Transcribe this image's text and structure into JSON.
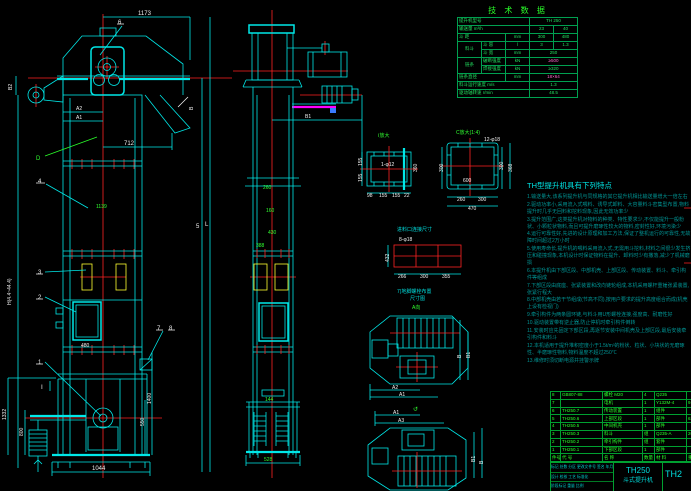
{
  "front_view": {
    "balloons": {
      "n1": "1",
      "n2": "2",
      "n3": "3",
      "n4": "4",
      "n5": "5",
      "n6": "6",
      "n7": "7",
      "n8": "8",
      "d": "D",
      "section": "Ⅰ"
    },
    "dims": {
      "overall_width": "1173",
      "chute": "712",
      "a1": "A1",
      "a2": "A2",
      "b2": "B2",
      "b": "B",
      "height": "H(4.4~44.4)",
      "length": "L",
      "pitch": "1139",
      "door": "480",
      "base": "1044",
      "boot_height": "1400",
      "boot_shaft": "550",
      "left_a": "1332",
      "left_b": "800"
    }
  },
  "side_view": {
    "dims": {
      "b1": "B1",
      "top": "260",
      "neck": "160",
      "mid": "430",
      "width": "388",
      "plate": "144",
      "base": "528"
    }
  },
  "details": {
    "detail_i": {
      "label": "Ⅰ放大",
      "hole": "1-φ12",
      "left_a": "155",
      "left_b": "155",
      "right": "360",
      "bot_a": "98",
      "bot_b": "155",
      "bot_c": "155",
      "bot_d": "22"
    },
    "detail_c": {
      "label": "C放大(1:4)",
      "holes": "12-φ18",
      "inner": "600",
      "left": "300",
      "right_a": "300",
      "right_b": "368",
      "bot_a": "260",
      "bot_b": "300",
      "bot_total": "470"
    },
    "outlet": {
      "label": "进料口连接尺寸",
      "holes": "8-φ18",
      "left": "432",
      "bot_a": "266",
      "bot_b": "300",
      "bot_c": "355"
    },
    "layout_label_1": "7)地脚螺栓布置",
    "layout_label_2": "尺寸图",
    "view_a": "A向",
    "rotate_mark": "↺",
    "plan_top": {
      "a2": "A2",
      "a1": "A1",
      "b": "B",
      "b1": "B1"
    },
    "plan_bottom": {
      "a1": "A1",
      "a3": "A3",
      "b": "B",
      "b1": "B1"
    }
  },
  "tech_table": {
    "title": "技 术 数 据",
    "rows": [
      {
        "label": "提升机型号",
        "value": "TH 250"
      },
      {
        "label": "输送量 m³/h",
        "v1": "23",
        "v2": "40"
      },
      {
        "label": "斗 距",
        "unit": "mm",
        "v1": "300",
        "v2": "480"
      },
      {
        "group": "料斗",
        "label": "斗 容",
        "unit": "l",
        "v1": "3",
        "v2": "1.3"
      },
      {
        "label": "斗 宽",
        "unit": "mm",
        "value": "250"
      },
      {
        "group": "链条",
        "label": "破断强度",
        "unit": "kN",
        "value": "≥500"
      },
      {
        "label": "焊接强度",
        "unit": "kN",
        "value": "≥320"
      },
      {
        "label": "链条直径",
        "unit": "mm",
        "value": "18×64"
      },
      {
        "label": "料斗运行速度 m/s",
        "value": "1.3"
      },
      {
        "label": "驱动轴转速 r/min",
        "value": "48.5"
      }
    ]
  },
  "features": {
    "title": "TH型提升机具有下列特点",
    "lines": [
      "1.输送量大,该系列提升机与同规格的其它提升机相比输送量增大一倍左右",
      "2.驱动功率小,采用流入式喂料、诱导式卸料、大容量料斗密集型布置,物料提升时几乎无回料和挖料现象,因此无效功率少",
      "3.提升范围广,这类提升机对物料的种类、特性要求少,不仅能提升一般粉状、小颗粒状物料,而且可提升磨琢性较大的物料,密封性好,环境污染少",
      "4.运行可靠性好,先进的设计原理和加工方法,保证了整机运行的可靠性,无故障时间超过2万小时",
      "5.使用寿命长,提升机的喂料采用流入式,无需用斗挖料,材料之间很少发生挤压和碰撞现象,本机设计时保证物料在提升、卸料时少有撒落,减少了机械磨损",
      "6.本提升机由下部区段、中部机壳、上部区段、传动装置、料斗、牵引构件等组成",
      "7.下部区段由底座、张紧装置和改向链轮组成,本机采用螺杆重锤张紧装置,张紧行程大",
      "8.中部机壳由若干节组成(节高不同),按用户要求的提升高度组合而成(机壳上设有检视门)",
      "9.牵引构件为两条圆环链,与料斗用U形螺栓连接,强度高、耐磨性好",
      "10.驱动装置带有逆止器,防止停机时牵引构件倒转",
      "11.安装时应先固定下部区段,再逐节安装中间机壳及上部区段,最后安装牵引构件和料斗",
      "12.本机适用于提升堆积密度小于1.5t/m³的粉状、粒状、小块状的无磨琢性、半磨琢性物料,物料温度不超过250℃",
      "13.维修时须切断电源并挂警示牌"
    ]
  },
  "parts_list": {
    "header": {
      "no": "件号",
      "code": "代  号",
      "name": "名  称",
      "qty": "数量",
      "material": "材  料",
      "weight": "重量"
    },
    "rows": [
      {
        "no": "8",
        "code": "GB807-88",
        "name": "螺栓 M20",
        "qty": "4",
        "material": "Q235",
        "weight": ""
      },
      {
        "no": "7",
        "code": "",
        "name": "电机",
        "qty": "1",
        "material": "Y132M-4",
        "weight": "9.06"
      },
      {
        "no": "6",
        "code": "TH250.7",
        "name": "传动装置",
        "qty": "1",
        "material": "组件",
        "weight": ""
      },
      {
        "no": "5",
        "code": "TH250.6",
        "name": "上部区段",
        "qty": "1",
        "material": "部件",
        "weight": "63.5"
      },
      {
        "no": "4",
        "code": "TH250.5",
        "name": "中间机壳",
        "qty": "1",
        "material": "部件",
        "weight": ""
      },
      {
        "no": "3",
        "code": "TH250.3",
        "name": "料斗",
        "qty": "组",
        "material": "Q235-A",
        "weight": "208"
      },
      {
        "no": "2",
        "code": "TH250.2",
        "name": "牵引构件",
        "qty": "组",
        "material": "套件",
        "weight": ""
      },
      {
        "no": "1",
        "code": "TH250.1",
        "name": "下部区段",
        "qty": "1",
        "material": "部件",
        "weight": ""
      }
    ]
  },
  "title_block": {
    "model": "TH250",
    "product": "斗式提升机",
    "drawing_no": "TH2",
    "rev_row": "标记 处数 分区 更改文件号 签名 年月日",
    "sign_row": "设计 校核 工艺 标准化",
    "extra_row": "阶段标记 重量 比例"
  }
}
